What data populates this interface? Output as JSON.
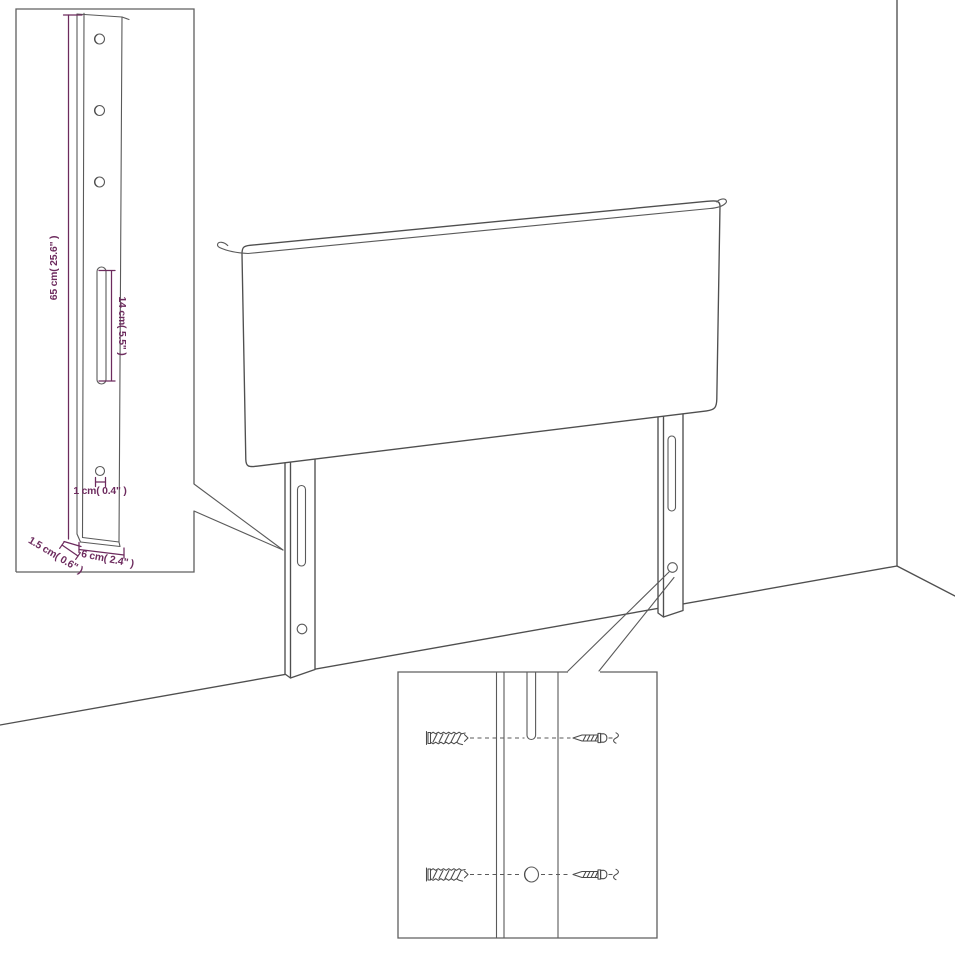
{
  "diagram": {
    "title": "headboard-dimension-diagram",
    "colors": {
      "background": "#ffffff",
      "line": "#4f4f4f",
      "dimension": "#6d2b5e"
    },
    "inset_leg_side_view": {
      "labels": {
        "height": "65 cm( 25.6\" )",
        "slot_length": "14 cm( 5.5\" )",
        "hole_diameter": "1 cm( 0.4\" )",
        "depth": "1.5 cm( 0.6\" )",
        "width": "6 cm( 2.4\" )"
      }
    },
    "inset_mounting_detail": {
      "icons": [
        "wall-plug-icon",
        "screw-icon",
        "mounting-hole",
        "mounting-slot"
      ]
    }
  }
}
